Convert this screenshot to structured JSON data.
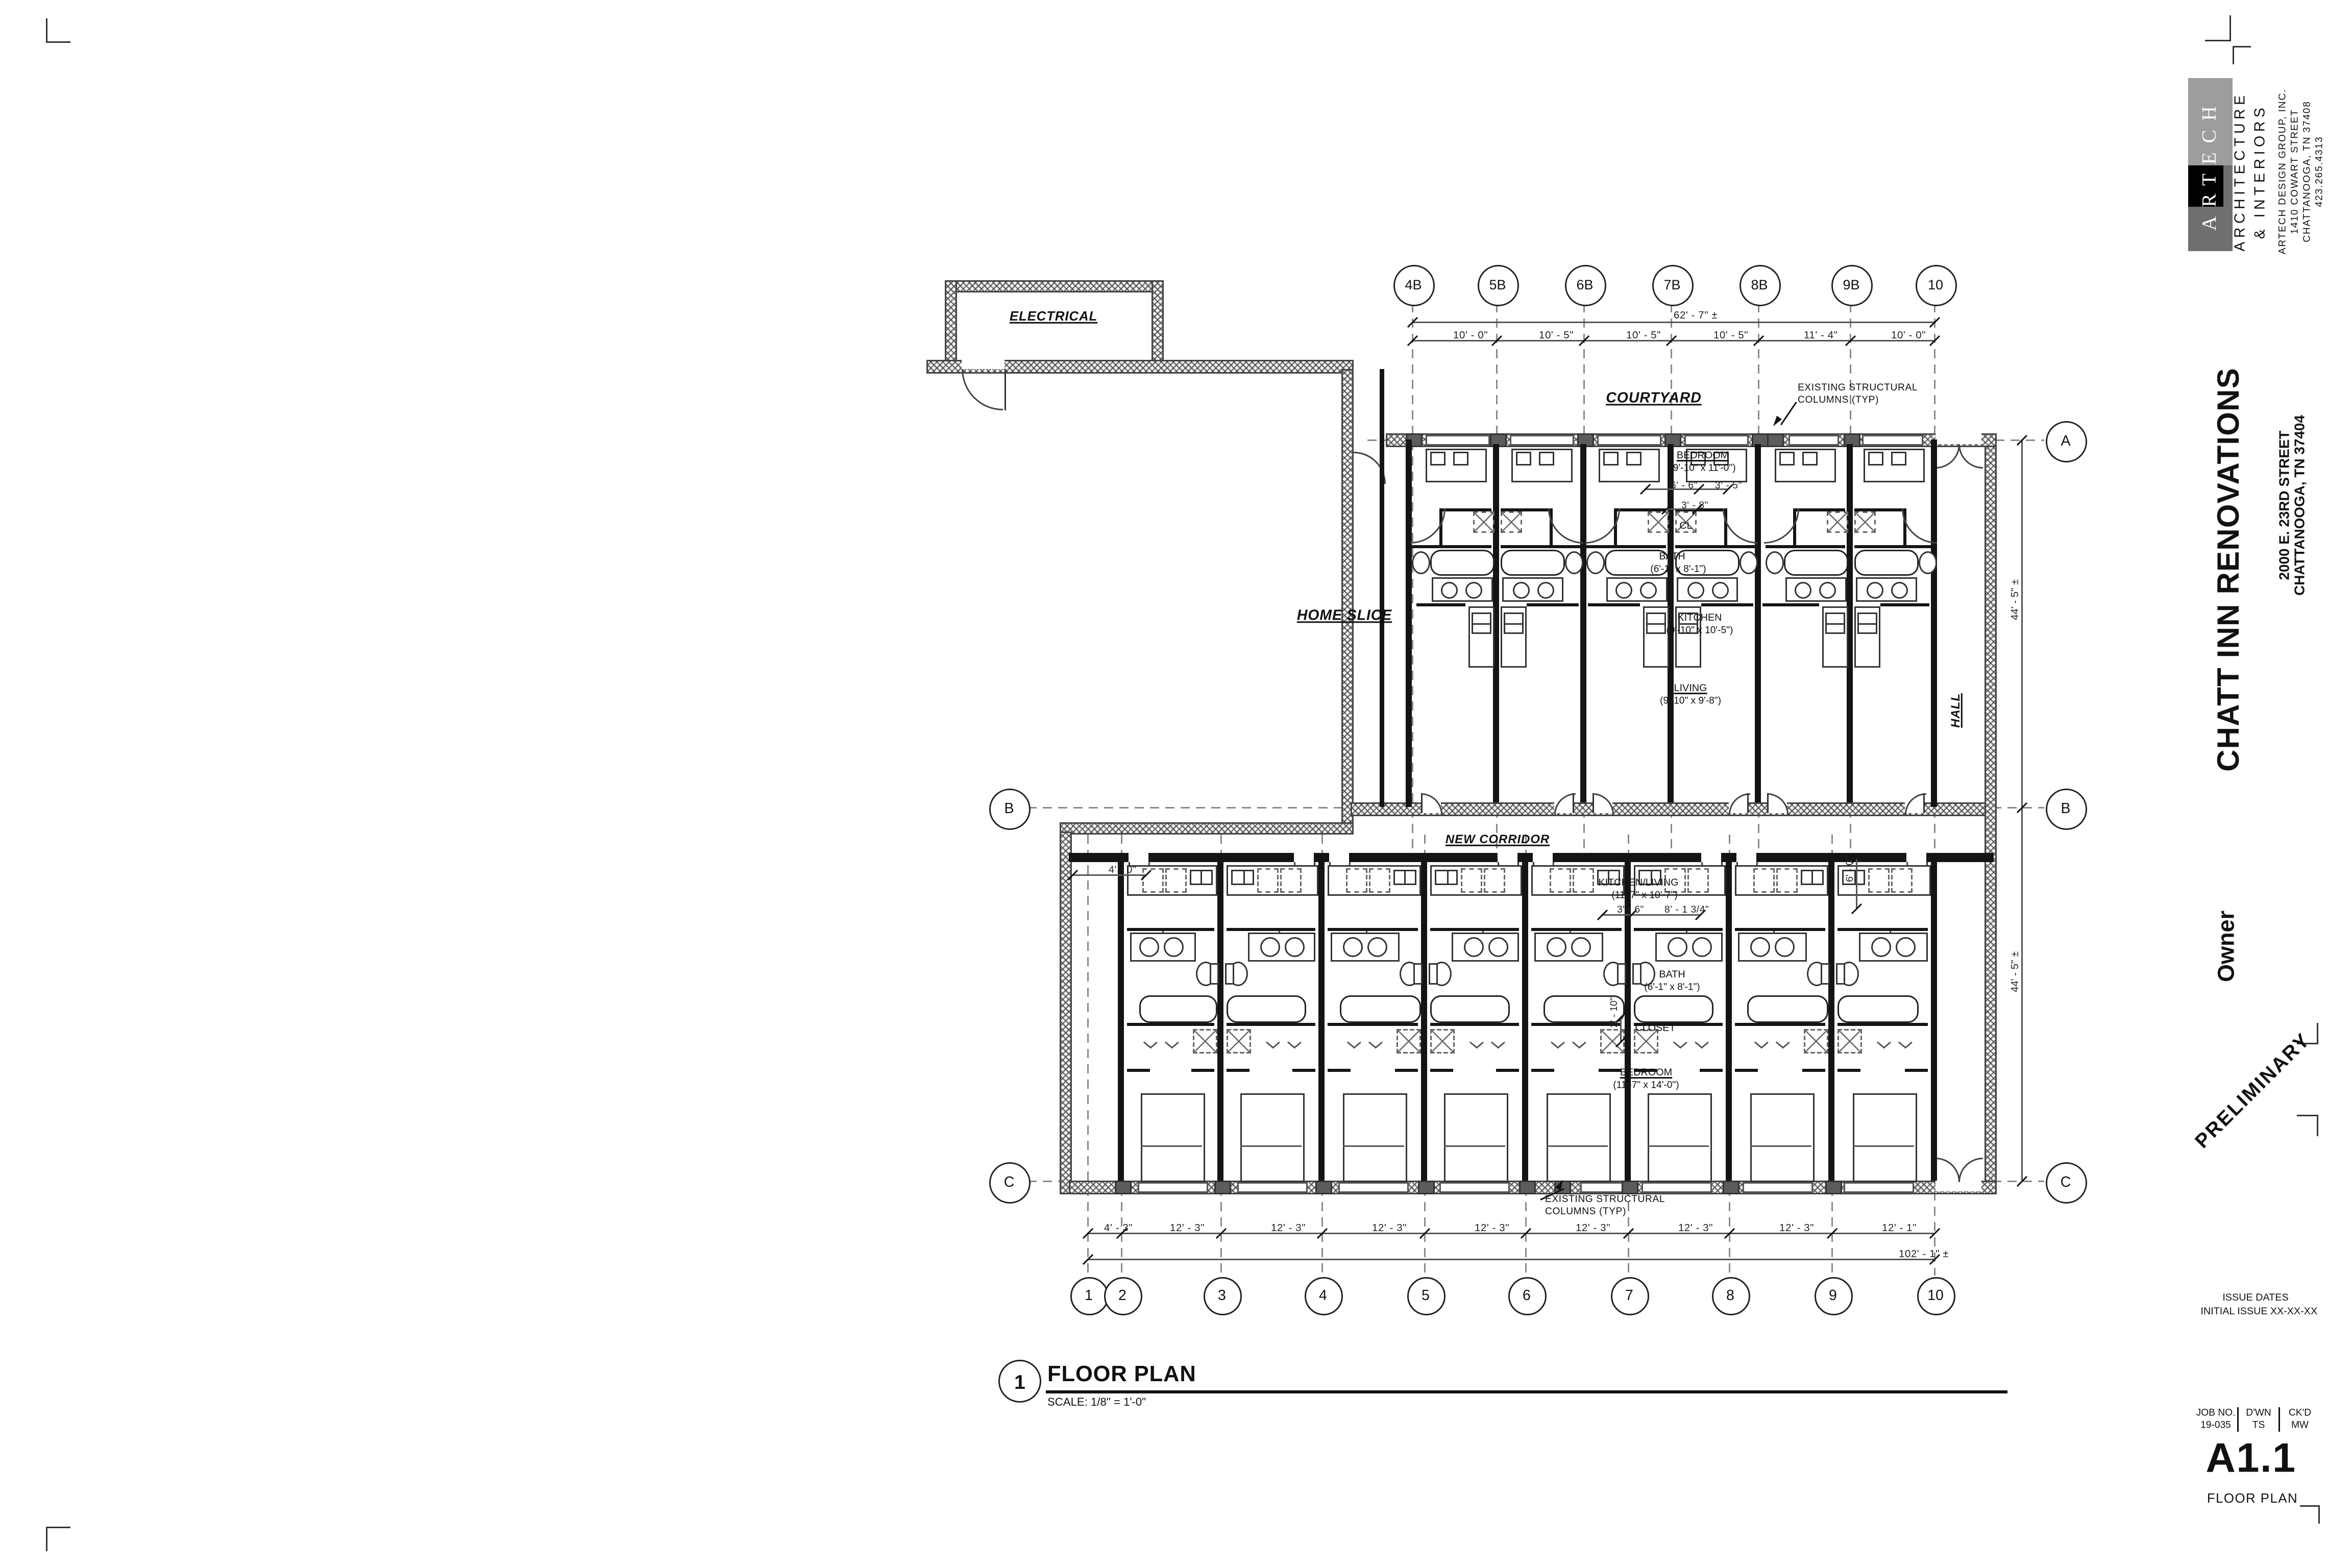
{
  "sheet": {
    "firm": {
      "logo_text": "ARTECH",
      "line1": "ARCHITECTURE",
      "line2": "& INTERIORS",
      "line3": "ARTECH DESIGN GROUP, INC.",
      "line4": "1410 COWART STREET",
      "line5": "CHATTANOOGA, TN 37408",
      "line6": "423.265.4313"
    },
    "project": {
      "title": "CHATT INN RENOVATIONS",
      "address1": "2000 E. 23RD STREET",
      "address2": "CHATTANOOGA, TN 37404"
    },
    "client_label": "Owner",
    "stamp": "PRELIMINARY",
    "issues": {
      "header": "ISSUE DATES",
      "initial_label": "INITIAL ISSUE",
      "initial_date": "XX-XX-XX"
    },
    "job": {
      "no_label": "JOB NO.",
      "no": "19-035",
      "drawn_label": "D'WN",
      "drawn": "TS",
      "checked_label": "CK'D",
      "checked": "MW"
    },
    "sheet_number": "A1.1",
    "sheet_title": "FLOOR PLAN"
  },
  "drawing_title": {
    "number": "1",
    "name": "FLOOR PLAN",
    "scale": "SCALE: 1/8\" = 1'-0\""
  },
  "grids": {
    "top": [
      "4B",
      "5B",
      "6B",
      "7B",
      "8B",
      "9B",
      "10"
    ],
    "bottom": [
      "1",
      "2",
      "3",
      "4",
      "5",
      "6",
      "7",
      "8",
      "9",
      "10"
    ],
    "left": [
      "B",
      "C"
    ],
    "right": [
      "A",
      "B",
      "C"
    ]
  },
  "dims": {
    "top_overall": "62' - 7\" ±",
    "top_segments": [
      "10' - 0\"",
      "10' - 5\"",
      "10' - 5\"",
      "10' - 5\"",
      "11' - 4\"",
      "10' - 0\""
    ],
    "bottom_overall": "102' - 1\" ±",
    "bottom_segments": [
      "4' - 3\"",
      "12' - 3\"",
      "12' - 3\"",
      "12' - 3\"",
      "12' - 3\"",
      "12' - 3\"",
      "12' - 3\"",
      "12' - 3\"",
      "12' - 1\""
    ],
    "right_upper": "44' - 5\" ±",
    "right_lower": "44' - 5\" ±",
    "corridor_left": "4' - 0\"",
    "corridor_right": "6' - 0\"",
    "upper_a": "6' - 6\"",
    "upper_b": "3' - 5\"",
    "upper_c": "3' - 8\"",
    "lower_a": "3' - 6\"",
    "lower_b": "8' - 1 3/4\"",
    "lower_c": "2' - 10\""
  },
  "rooms": {
    "electrical": "ELECTRICAL",
    "courtyard": "COURTYARD",
    "home_slice": "HOME SLICE",
    "hall": "HALL",
    "new_corridor": "NEW CORRIDOR",
    "upper_unit": {
      "bedroom": "BEDROOM",
      "bedroom_dim": "(9'-10\" x 11'-0\")",
      "closet": "CL",
      "bath": "BATH",
      "bath_dim": "(6'-1\" x 8'-1\")",
      "kitchen": "KITCHEN",
      "kitchen_dim": "(9'-10\" x 10'-5\")",
      "living": "LIVING",
      "living_dim": "(9'-10\" x 9'-8\")"
    },
    "lower_unit": {
      "kitchen_living": "KITCHEN/LIVING",
      "kitchen_living_dim": "(11'-7\" x 10'-7\")",
      "bath": "BATH",
      "bath_dim": "(6'-1\" x 8'-1\")",
      "closet": "CLOSET",
      "bedroom": "BEDROOM",
      "bedroom_dim": "(11'-7\" x 14'-0\")"
    }
  },
  "notes": {
    "columns_line1": "EXISTING STRUCTURAL",
    "columns_line2": "COLUMNS (TYP)"
  }
}
